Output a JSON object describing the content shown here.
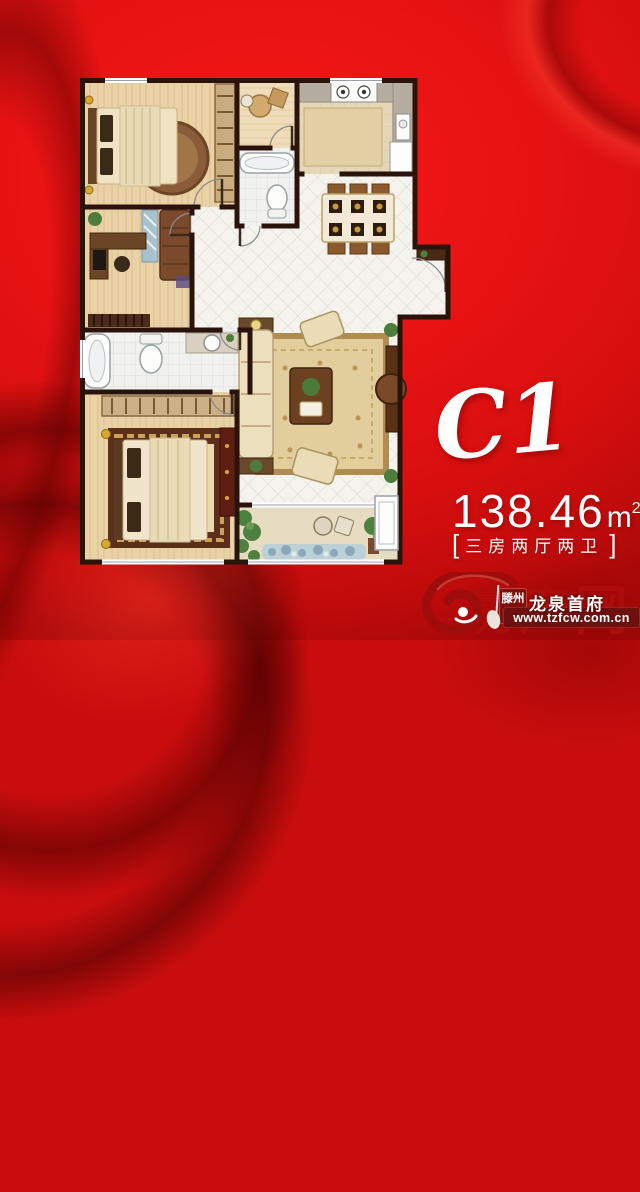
{
  "poster": {
    "unit": {
      "label": "C1",
      "area_number": "138.46",
      "area_unit": "m",
      "area_unit_exponent": "2",
      "bracket_left": "[",
      "layout_text": "三房两厅两卫",
      "bracket_right": "]"
    },
    "branding": {
      "badge_text": "滕州",
      "site_name": "龙泉首府",
      "url": "www.tzfcw.com.cn",
      "watermark_text": "房产网"
    },
    "colors": {
      "background_red": "#e81313",
      "deep_fold_red": "#8e0808",
      "wall_brown": "#2a130b",
      "text_white": "#ffffff",
      "watermark_red": "#a50e0e"
    }
  }
}
